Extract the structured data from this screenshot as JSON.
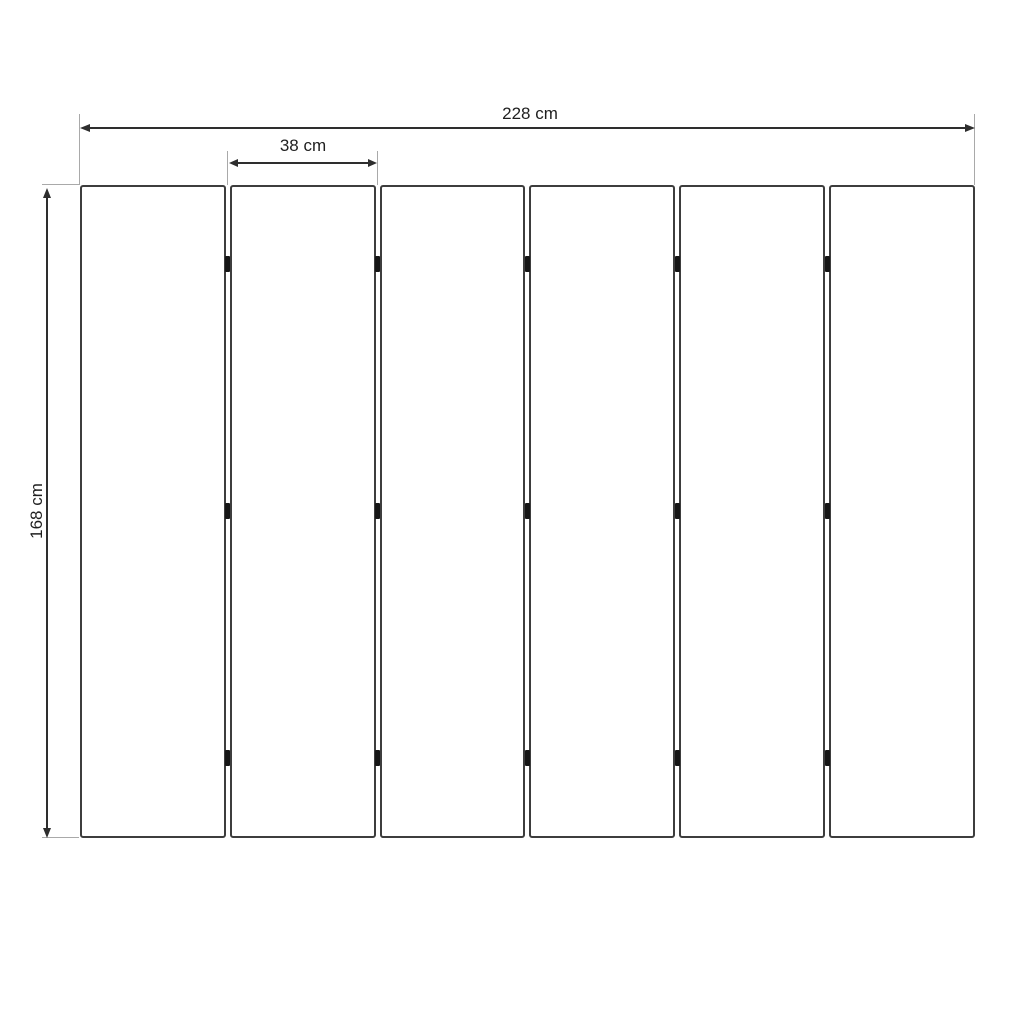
{
  "diagram": {
    "dimensions": {
      "total_width": {
        "label": "228 cm",
        "value_cm": 228
      },
      "panel_width": {
        "label": "38 cm",
        "value_cm": 38
      },
      "height": {
        "label": "168 cm",
        "value_cm": 168
      }
    },
    "panels": {
      "count": 6,
      "hinge_rows_per_gap": 3
    },
    "colors": {
      "background": "#ffffff",
      "panel_border": "#3d3d3d",
      "dimension_line": "#2e2e2e",
      "extension_line": "#a9a9a9",
      "hinge": "#161616",
      "text": "#1f1f1f"
    }
  }
}
